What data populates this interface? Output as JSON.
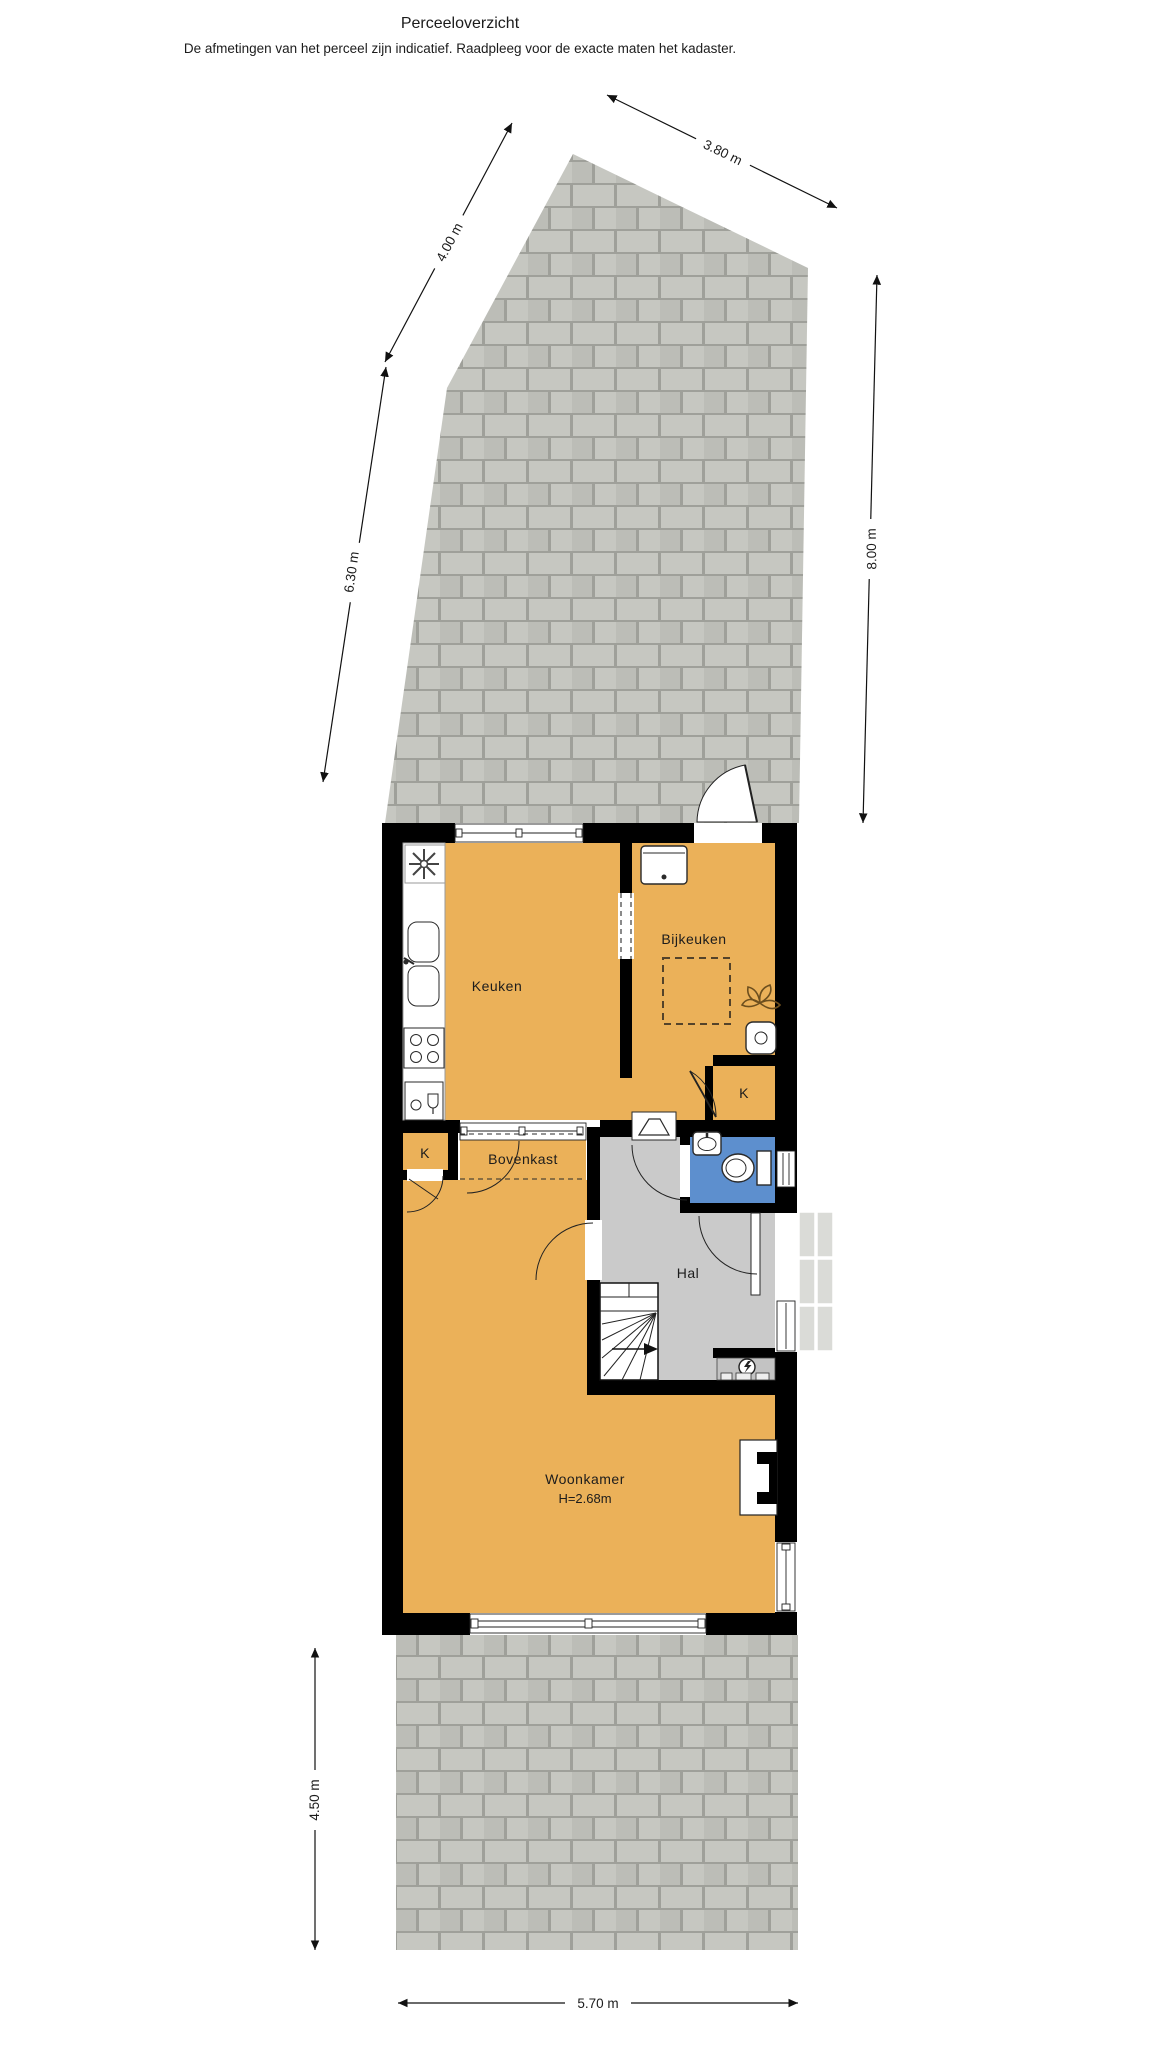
{
  "header": {
    "title": "Perceeloverzicht",
    "disclaimer": "De afmetingen van het perceel zijn indicatief. Raadpleeg voor de exacte maten het kadaster."
  },
  "dimensions": {
    "d380": {
      "label": "3.80 m"
    },
    "d400": {
      "label": "4.00 m"
    },
    "d630": {
      "label": "6.30 m"
    },
    "d800": {
      "label": "8.00 m"
    },
    "d450": {
      "label": "4.50 m"
    },
    "d570": {
      "label": "5.70 m"
    }
  },
  "rooms": {
    "keuken": {
      "label": "Keuken"
    },
    "bijkeuken": {
      "label": "Bijkeuken"
    },
    "kast_left": {
      "label": "K"
    },
    "kast_right": {
      "label": "K"
    },
    "bovenkast": {
      "label": "Bovenkast"
    },
    "hal": {
      "label": "Hal"
    },
    "woonkamer": {
      "label": "Woonkamer",
      "height_note": "H=2.68m"
    }
  },
  "icons": [
    "extractor-fan-icon",
    "sink-double-icon",
    "hob-icon",
    "dishwasher-icon",
    "washing-machine-icon",
    "plant-icon",
    "laundry-sink-icon",
    "toilet-icon",
    "hand-basin-icon",
    "stairs-icon",
    "electric-meter-icon",
    "fireplace-icon"
  ],
  "colors": {
    "room_orange": "#ebb159",
    "hall_grey": "#cacaca",
    "toilet_blue": "#5d8fce",
    "wall_black": "#000000",
    "paving_tile": "#c6c7c1",
    "paving_tile_alt": "#bcbdb7",
    "paving_joint": "#9fa09a"
  }
}
